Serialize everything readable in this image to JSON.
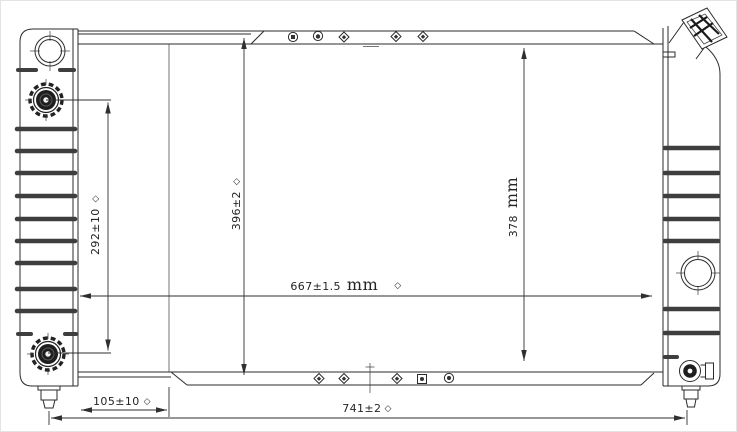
{
  "drawing": {
    "type": "radiator engineering drawing",
    "dimensions": {
      "d292": {
        "value": "292±10",
        "suffix": "◇"
      },
      "d396": {
        "value": "396±2",
        "suffix": "◇"
      },
      "d378": {
        "value": "378",
        "unit": "mm"
      },
      "d667": {
        "value": "667±1.5",
        "unit": "mm",
        "suffix": "◇"
      },
      "d105": {
        "value": "105±10",
        "suffix": "◇"
      },
      "d741": {
        "value": "741±2",
        "suffix": "◇"
      }
    }
  }
}
